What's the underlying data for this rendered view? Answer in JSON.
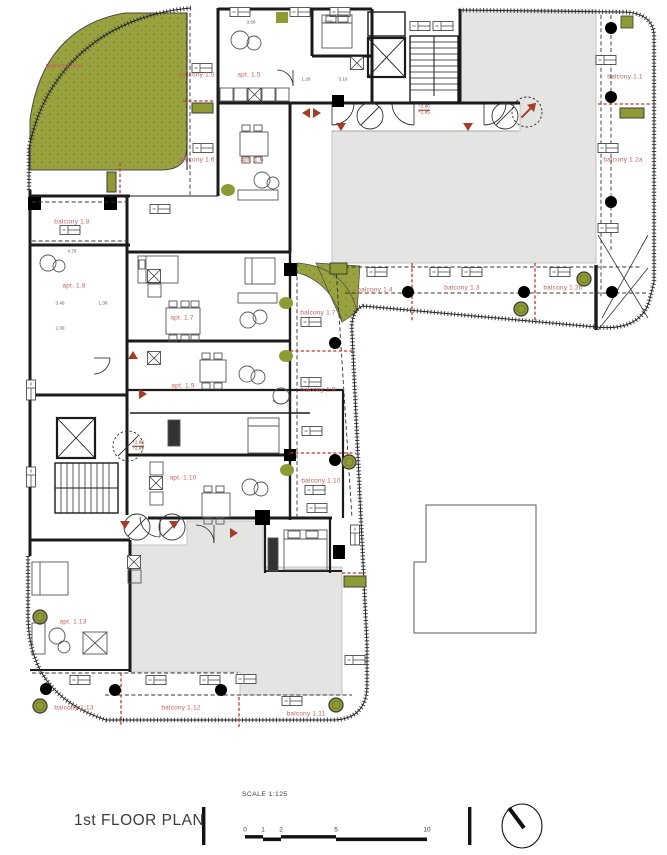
{
  "title_block": {
    "title": "1st FLOOR PLAN",
    "scale_label": "SCALE 1:125",
    "scale_ticks": [
      {
        "text": "0",
        "x": 245
      },
      {
        "text": "1",
        "x": 263
      },
      {
        "text": "2",
        "x": 281
      },
      {
        "text": "5",
        "x": 336
      },
      {
        "text": "10",
        "x": 427
      }
    ],
    "north_icon": "north-arrow"
  },
  "colors": {
    "planted_green": "#9aa23d",
    "planter_green": "#8f9a35",
    "courtyard_gray": "#e4e4e2",
    "label_red": "#c4605c",
    "arrow_red": "#a53c27",
    "red_divider": "#c0392b",
    "wall_black": "#1b1b1b"
  },
  "plan": {
    "area_labels": [
      {
        "id": "planted-roof",
        "text": "planted roof",
        "x": 64,
        "y": 66
      },
      {
        "id": "balcony-1-5",
        "text": "balcony 1.5",
        "x": 197,
        "y": 75
      },
      {
        "id": "apt-1-5",
        "text": "apt. 1.5",
        "x": 249,
        "y": 75
      },
      {
        "id": "balcony-1-6",
        "text": "balcony 1.6",
        "x": 197,
        "y": 160
      },
      {
        "id": "apt-1-6",
        "text": "apt. 1.6",
        "x": 252,
        "y": 160
      },
      {
        "id": "balcony-1-8",
        "text": "balcony 1.8",
        "x": 72,
        "y": 222
      },
      {
        "id": "apt-1-8",
        "text": "apt. 1.8",
        "x": 74,
        "y": 286
      },
      {
        "id": "apt-1-7",
        "text": "apt. 1.7",
        "x": 182,
        "y": 318
      },
      {
        "id": "balcony-1-7",
        "text": "balcony 1.7",
        "x": 318,
        "y": 313
      },
      {
        "id": "balcony-1-4",
        "text": "balcony 1.4",
        "x": 375,
        "y": 290
      },
      {
        "id": "balcony-1-3",
        "text": "balcony 1.3",
        "x": 462,
        "y": 288
      },
      {
        "id": "balcony-1-2b",
        "text": "balcony 1.2b",
        "x": 563,
        "y": 288
      },
      {
        "id": "balcony-1-1",
        "text": "balcony 1.1",
        "x": 625,
        "y": 77
      },
      {
        "id": "balcony-1-2a",
        "text": "balcony 1.2a",
        "x": 623,
        "y": 160
      },
      {
        "id": "apt-1-9",
        "text": "apt. 1.9",
        "x": 183,
        "y": 386
      },
      {
        "id": "balcony-1-9",
        "text": "balcony 1.9",
        "x": 318,
        "y": 390
      },
      {
        "id": "apt-1-10",
        "text": "apt. 1.10",
        "x": 183,
        "y": 478
      },
      {
        "id": "balcony-1-10",
        "text": "balcony 1.10",
        "x": 321,
        "y": 481
      },
      {
        "id": "apt-1-13",
        "text": "apt. 1.13",
        "x": 73,
        "y": 622
      },
      {
        "id": "balcony-1-13",
        "text": "balcony 1.13",
        "x": 74,
        "y": 708
      },
      {
        "id": "balcony-1-12",
        "text": "balcony 1.12",
        "x": 181,
        "y": 708
      },
      {
        "id": "balcony-1-11",
        "text": "balcony 1.11",
        "x": 306,
        "y": 714
      }
    ],
    "level_markers": [
      {
        "id": "level-corridor",
        "line1": "+2.90",
        "line2": "+2.85",
        "x": 424,
        "y": 110
      },
      {
        "id": "level-hall",
        "line1": "+2.90",
        "line2": "+2.85",
        "x": 138,
        "y": 446
      }
    ],
    "dimensions": [
      {
        "text": "3.60",
        "x": 251,
        "y": 22
      },
      {
        "text": "2.30",
        "x": 328,
        "y": 22
      },
      {
        "text": "1.20",
        "x": 306,
        "y": 79
      },
      {
        "text": "3.10",
        "x": 343,
        "y": 79
      },
      {
        "text": "4.70",
        "x": 72,
        "y": 251
      },
      {
        "text": "3.40",
        "x": 60,
        "y": 303
      },
      {
        "text": "1.30",
        "x": 103,
        "y": 303
      },
      {
        "text": "2.30",
        "x": 60,
        "y": 328
      }
    ]
  }
}
